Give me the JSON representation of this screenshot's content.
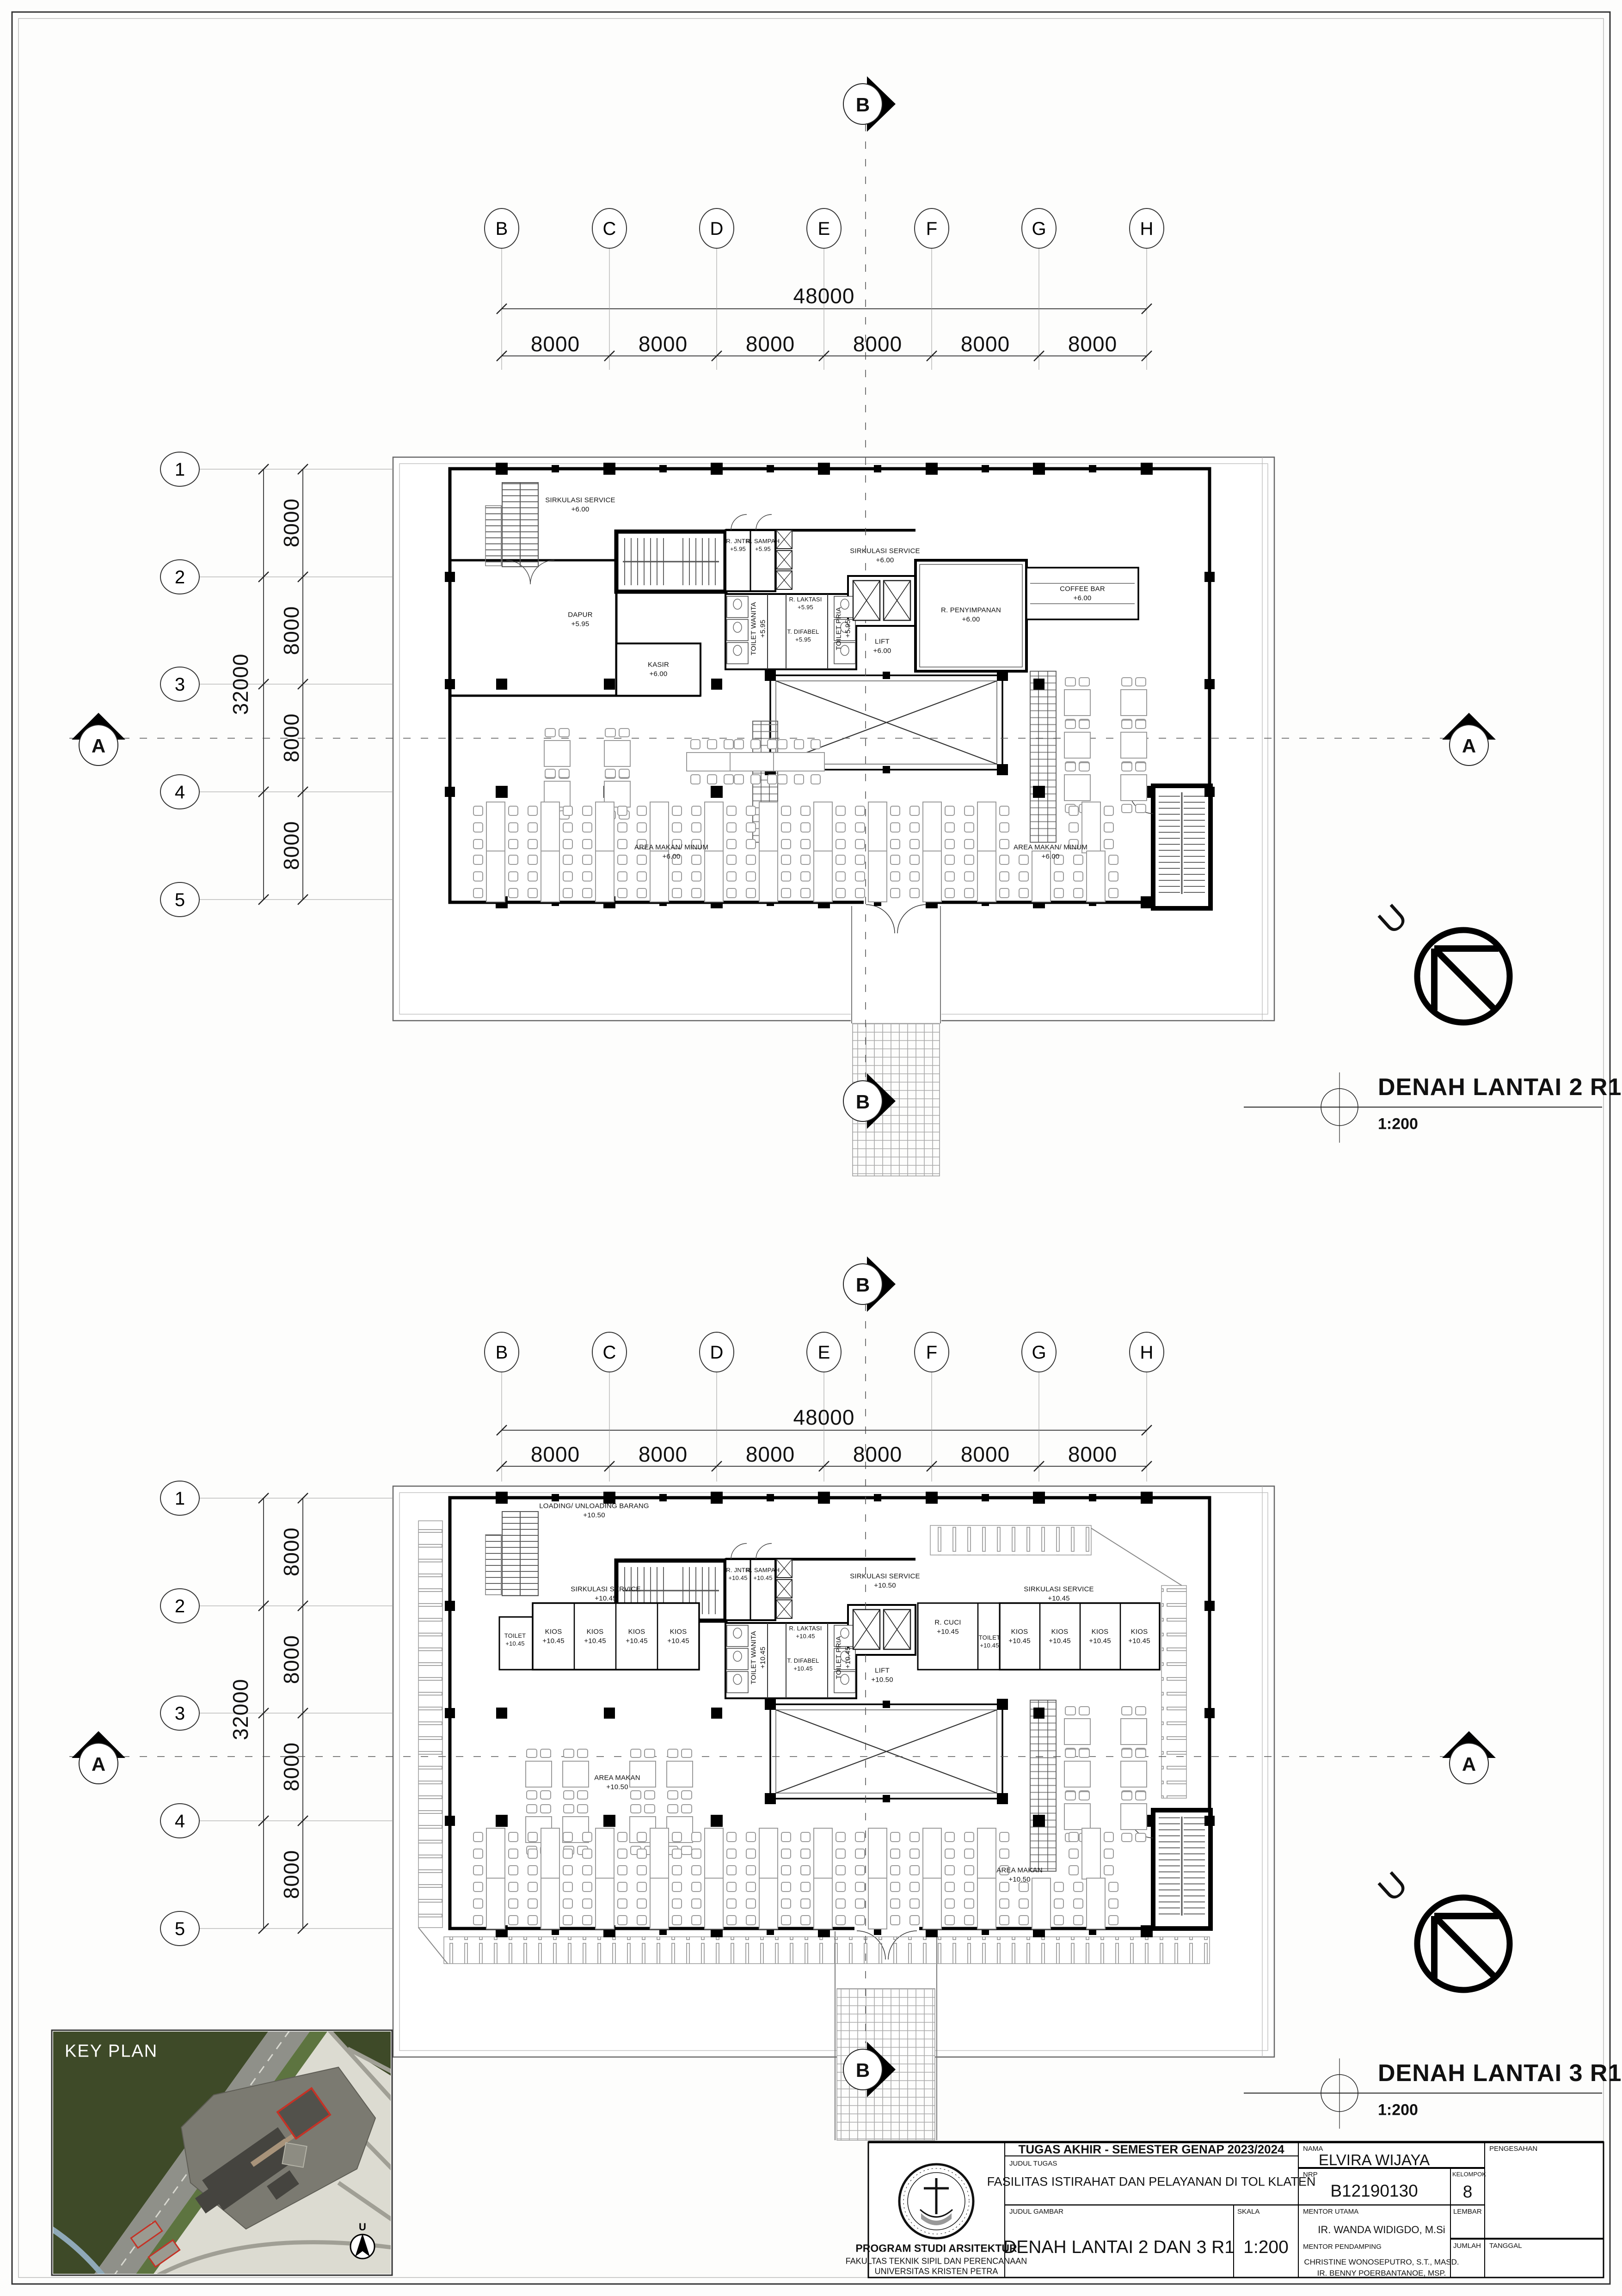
{
  "sheet": {
    "key_plan_label": "KEY PLAN"
  },
  "grid": {
    "cols": [
      "B",
      "C",
      "D",
      "E",
      "F",
      "G",
      "H"
    ],
    "rows": [
      "1",
      "2",
      "3",
      "4",
      "5"
    ],
    "h_total": "48000",
    "h_seg": "8000",
    "v_total": "32000",
    "v_seg": "8000"
  },
  "sections": {
    "a": "A",
    "b": "B"
  },
  "north": {
    "letter": "U"
  },
  "l2": {
    "title": "DENAH LANTAI 2 R1",
    "scale": "1:200",
    "rooms": {
      "sirk_a": {
        "n": "SIRKULASI SERVICE",
        "lv": "+6.00"
      },
      "sirk_b": {
        "n": "SIRKULASI SERVICE",
        "lv": "+6.00"
      },
      "dapur": {
        "n": "DAPUR",
        "lv": "+5.95"
      },
      "kasir": {
        "n": "KASIR",
        "lv": "+6.00"
      },
      "rjntr": {
        "n": "R. JNTR",
        "lv": "+5.95"
      },
      "rsampah": {
        "n": "R. SAMPAH",
        "lv": "+5.95"
      },
      "twanita": {
        "n": "TOILET WANITA",
        "lv": "+5.95"
      },
      "rlaktasi": {
        "n": "R. LAKTASI",
        "lv": "+5.95"
      },
      "tdifabel": {
        "n": "T. DIFABEL",
        "lv": "+5.95"
      },
      "tpria": {
        "n": "TOILET PRIA",
        "lv": "+5.95"
      },
      "lift": {
        "n": "LIFT",
        "lv": "+6.00"
      },
      "penyimpanan": {
        "n": "R. PENYIMPANAN",
        "lv": "+6.00"
      },
      "coffeebar": {
        "n": "COFFEE BAR",
        "lv": "+6.00"
      },
      "makan_a": {
        "n": "AREA MAKAN/ MINUM",
        "lv": "+6.00"
      },
      "makan_b": {
        "n": "AREA MAKAN/ MINUM",
        "lv": "+6.00"
      }
    }
  },
  "l3": {
    "title": "DENAH LANTAI 3 R1",
    "scale": "1:200",
    "rooms": {
      "loading": {
        "n": "LOADING/ UNLOADING BARANG",
        "lv": "+10.50"
      },
      "sirk_serv": {
        "n": "SIRKULASI SERVICE",
        "lv": "+10.50"
      },
      "sirk_a": {
        "n": "SIRKULASI SERVICE",
        "lv": "+10.45"
      },
      "sirk_b": {
        "n": "SIRKULASI SERVICE",
        "lv": "+10.45"
      },
      "toilet_l": {
        "n": "TOILET",
        "lv": "+10.45"
      },
      "kios1": {
        "n": "KIOS",
        "lv": "+10.45"
      },
      "kios2": {
        "n": "KIOS",
        "lv": "+10.45"
      },
      "kios3": {
        "n": "KIOS",
        "lv": "+10.45"
      },
      "kios4": {
        "n": "KIOS",
        "lv": "+10.45"
      },
      "rjntr": {
        "n": "R. JNTR",
        "lv": "+10.45"
      },
      "rsampah": {
        "n": "R. SAMPAH",
        "lv": "+10.45"
      },
      "twanita": {
        "n": "TOILET WANITA",
        "lv": "+10.45"
      },
      "rlaktasi": {
        "n": "R. LAKTASI",
        "lv": "+10.45"
      },
      "tdifabel": {
        "n": "T. DIFABEL",
        "lv": "+10.45"
      },
      "tpria": {
        "n": "TOILET PRIA",
        "lv": "+10.45"
      },
      "rcuci": {
        "n": "R. CUCI",
        "lv": "+10.45"
      },
      "toilet_r": {
        "n": "TOILET",
        "lv": "+10.45"
      },
      "kios5": {
        "n": "KIOS",
        "lv": "+10.45"
      },
      "kios6": {
        "n": "KIOS",
        "lv": "+10.45"
      },
      "kios7": {
        "n": "KIOS",
        "lv": "+10.45"
      },
      "kios8": {
        "n": "KIOS",
        "lv": "+10.45"
      },
      "lift": {
        "n": "LIFT",
        "lv": "+10.50"
      },
      "makan_a": {
        "n": "AREA MAKAN",
        "lv": "+10.50"
      },
      "makan_b": {
        "n": "AREA MAKAN",
        "lv": "+10.50"
      }
    }
  },
  "titleblock": {
    "header": "TUGAS AKHIR - SEMESTER GENAP 2023/2024",
    "labels": {
      "judul_tugas": "JUDUL TUGAS",
      "judul_gambar": "JUDUL GAMBAR",
      "skala": "SKALA",
      "nama": "NAMA",
      "nrp": "NRP",
      "kelompok": "KELOMPOK",
      "pengesahan": "PENGESAHAN",
      "mentor_utama": "MENTOR UTAMA",
      "mentor_pendamping": "MENTOR PENDAMPING",
      "lembar": "LEMBAR",
      "jumlah": "JUMLAH",
      "tanggal": "TANGGAL"
    },
    "values": {
      "judul_tugas": "FASILITAS ISTIRAHAT DAN PELAYANAN DI TOL KLATEN",
      "judul_gambar": "DENAH LANTAI 2 DAN 3 R1",
      "skala": "1:200",
      "nama": "ELVIRA WIJAYA",
      "nrp": "B12190130",
      "kelompok": "8",
      "mentor_utama": "IR. WANDA WIDIGDO, M.Si",
      "mentor_pendamping_1": "CHRISTINE WONOSEPUTRO, S.T., MASD.",
      "mentor_pendamping_2": "IR. BENNY POERBANTANOE, MSP."
    },
    "institution": {
      "line1": "PROGRAM STUDI ARSITEKTUR",
      "line2": "FAKULTAS TEKNIK SIPIL DAN PERENCANAAN",
      "line3": "UNIVERSITAS KRISTEN PETRA"
    }
  }
}
